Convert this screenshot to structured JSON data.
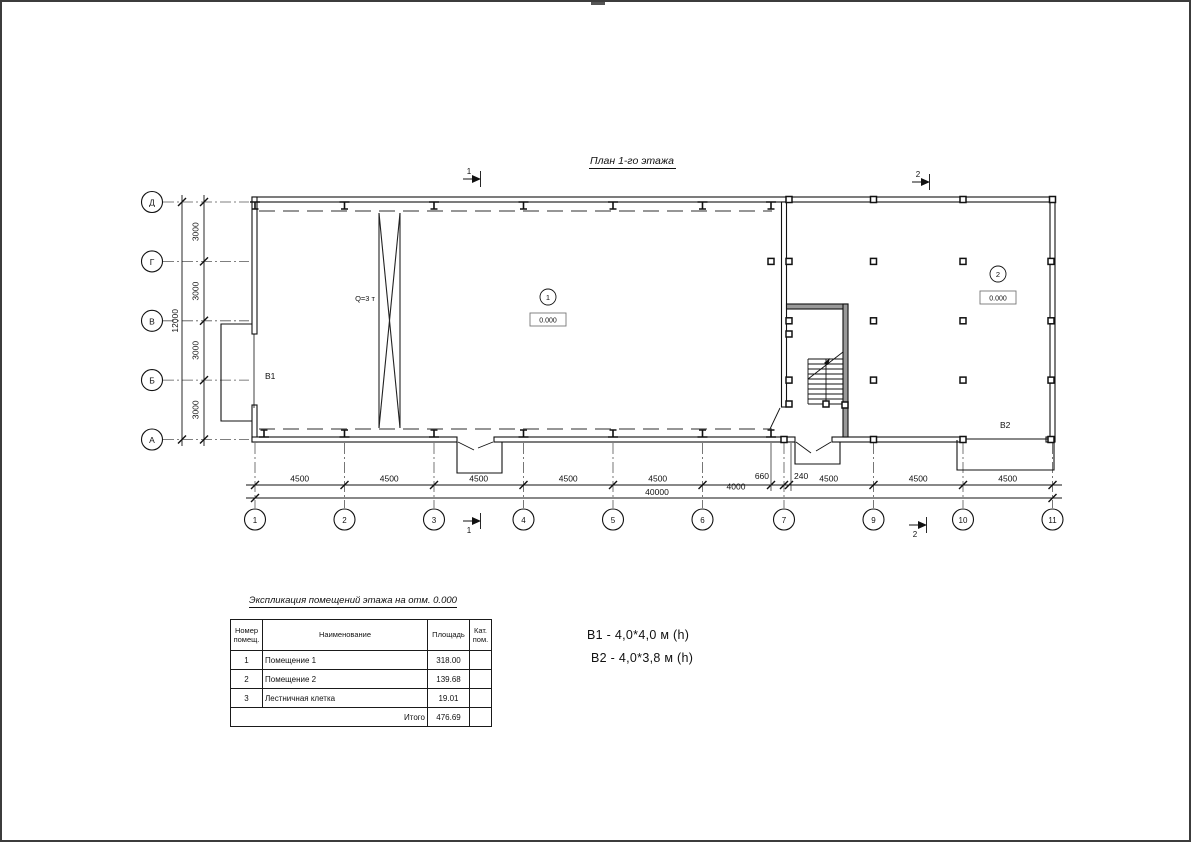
{
  "title": "План 1-го этажа",
  "plan": {
    "crane_label": "Q=3 т",
    "gate_b1_label": "В1",
    "gate_b2_label": "В2",
    "rooms": [
      {
        "number": "1",
        "elevation": "0.000"
      },
      {
        "number": "2",
        "elevation": "0.000"
      }
    ],
    "section_marks": {
      "top1": "1",
      "top2": "2",
      "bottom1": "1",
      "bottom2": "2"
    }
  },
  "axes": {
    "vertical": [
      "Д",
      "Г",
      "В",
      "Б",
      "А"
    ],
    "horizontal": [
      "1",
      "2",
      "3",
      "4",
      "5",
      "6",
      "7",
      "9",
      "10",
      "11"
    ]
  },
  "dimensions": {
    "left_segments": [
      "3000",
      "3000",
      "3000",
      "3000"
    ],
    "left_total": "12000",
    "bottom_segments": [
      "4500",
      "4500",
      "4500",
      "4500",
      "4500",
      "4000",
      "4500",
      "4500",
      "4500"
    ],
    "bottom_small": [
      "660",
      "240"
    ],
    "bottom_total": "40000"
  },
  "legend_table": {
    "title": "Экспликация помещений этажа на отм. 0.000",
    "headers": {
      "num": "Номер помещ.",
      "name": "Наименование",
      "area": "Площадь",
      "cat": "Кат. пом."
    },
    "rows": [
      {
        "num": "1",
        "name": "Помещение 1",
        "area": "318.00",
        "cat": ""
      },
      {
        "num": "2",
        "name": "Помещение 2",
        "area": "139.68",
        "cat": ""
      },
      {
        "num": "3",
        "name": "Лестничная клетка",
        "area": "19.01",
        "cat": ""
      }
    ],
    "total_label": "Итого",
    "total_value": "476.69"
  },
  "specs": {
    "b1": "В1  -  4,0*4,0 м (h)",
    "b2": "В2 - 4,0*3,8 м (h)"
  }
}
